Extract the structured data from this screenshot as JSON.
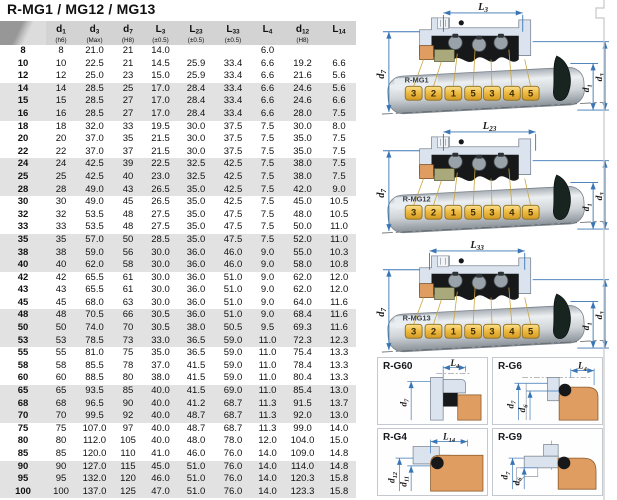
{
  "page_title": "R-MG1 / MG12 / MG13",
  "table": {
    "header": [
      {
        "base": "",
        "sub": "",
        "note": ""
      },
      {
        "base": "d",
        "sub": "1",
        "note": "(h6)"
      },
      {
        "base": "d",
        "sub": "3",
        "note": "(Max)"
      },
      {
        "base": "d",
        "sub": "7",
        "note": "(H8)"
      },
      {
        "base": "L",
        "sub": "3",
        "note": "(±0.5)"
      },
      {
        "base": "L",
        "sub": "23",
        "note": "(±0.5)"
      },
      {
        "base": "L",
        "sub": "33",
        "note": "(±0.5)"
      },
      {
        "base": "L",
        "sub": "4",
        "note": ""
      },
      {
        "base": "d",
        "sub": "12",
        "note": "(H8)"
      },
      {
        "base": "L",
        "sub": "14",
        "note": ""
      }
    ],
    "rows": [
      [
        "8",
        "8",
        "21.0",
        "21",
        "14.0",
        "",
        "",
        "6.0",
        "",
        ""
      ],
      [
        "10",
        "10",
        "22.5",
        "21",
        "14.5",
        "25.9",
        "33.4",
        "6.6",
        "19.2",
        "6.6"
      ],
      [
        "12",
        "12",
        "25.0",
        "23",
        "15.0",
        "25.9",
        "33.4",
        "6.6",
        "21.6",
        "5.6"
      ],
      [
        "14",
        "14",
        "28.5",
        "25",
        "17.0",
        "28.4",
        "33.4",
        "6.6",
        "24.6",
        "5.6"
      ],
      [
        "15",
        "15",
        "28.5",
        "27",
        "17.0",
        "28.4",
        "33.4",
        "6.6",
        "24.6",
        "6.6"
      ],
      [
        "16",
        "16",
        "28.5",
        "27",
        "17.0",
        "28.4",
        "33.4",
        "6.6",
        "28.0",
        "7.5"
      ],
      [
        "18",
        "18",
        "32.0",
        "33",
        "19.5",
        "30.0",
        "37.5",
        "7.5",
        "30.0",
        "8.0"
      ],
      [
        "20",
        "20",
        "37.0",
        "35",
        "21.5",
        "30.0",
        "37.5",
        "7.5",
        "35.0",
        "7.5"
      ],
      [
        "22",
        "22",
        "37.0",
        "37",
        "21.5",
        "30.0",
        "37.5",
        "7.5",
        "35.0",
        "7.5"
      ],
      [
        "24",
        "24",
        "42.5",
        "39",
        "22.5",
        "32.5",
        "42.5",
        "7.5",
        "38.0",
        "7.5"
      ],
      [
        "25",
        "25",
        "42.5",
        "40",
        "23.0",
        "32.5",
        "42.5",
        "7.5",
        "38.0",
        "7.5"
      ],
      [
        "28",
        "28",
        "49.0",
        "43",
        "26.5",
        "35.0",
        "42.5",
        "7.5",
        "42.0",
        "9.0"
      ],
      [
        "30",
        "30",
        "49.0",
        "45",
        "26.5",
        "35.0",
        "42.5",
        "7.5",
        "45.0",
        "10.5"
      ],
      [
        "32",
        "32",
        "53.5",
        "48",
        "27.5",
        "35.0",
        "47.5",
        "7.5",
        "48.0",
        "10.5"
      ],
      [
        "33",
        "33",
        "53.5",
        "48",
        "27.5",
        "35.0",
        "47.5",
        "7.5",
        "50.0",
        "11.0"
      ],
      [
        "35",
        "35",
        "57.0",
        "50",
        "28.5",
        "35.0",
        "47.5",
        "7.5",
        "52.0",
        "11.0"
      ],
      [
        "38",
        "38",
        "59.0",
        "56",
        "30.0",
        "36.0",
        "46.0",
        "9.0",
        "55.0",
        "10.3"
      ],
      [
        "40",
        "40",
        "62.0",
        "58",
        "30.0",
        "36.0",
        "46.0",
        "9.0",
        "58.0",
        "10.8"
      ],
      [
        "42",
        "42",
        "65.5",
        "61",
        "30.0",
        "36.0",
        "51.0",
        "9.0",
        "62.0",
        "12.0"
      ],
      [
        "43",
        "43",
        "65.5",
        "61",
        "30.0",
        "36.0",
        "51.0",
        "9.0",
        "62.0",
        "12.0"
      ],
      [
        "45",
        "45",
        "68.0",
        "63",
        "30.0",
        "36.0",
        "51.0",
        "9.0",
        "64.0",
        "11.6"
      ],
      [
        "48",
        "48",
        "70.5",
        "66",
        "30.5",
        "36.0",
        "51.0",
        "9.0",
        "68.4",
        "11.6"
      ],
      [
        "50",
        "50",
        "74.0",
        "70",
        "30.5",
        "38.0",
        "50.5",
        "9.5",
        "69.3",
        "11.6"
      ],
      [
        "53",
        "53",
        "78.5",
        "73",
        "33.0",
        "36.5",
        "59.0",
        "11.0",
        "72.3",
        "12.3"
      ],
      [
        "55",
        "55",
        "81.0",
        "75",
        "35.0",
        "36.5",
        "59.0",
        "11.0",
        "75.4",
        "13.3"
      ],
      [
        "58",
        "58",
        "85.5",
        "78",
        "37.0",
        "41.5",
        "59.0",
        "11.0",
        "78.4",
        "13.3"
      ],
      [
        "60",
        "60",
        "88.5",
        "80",
        "38.0",
        "41.5",
        "59.0",
        "11.0",
        "80.4",
        "13.3"
      ],
      [
        "65",
        "65",
        "93.5",
        "85",
        "40.0",
        "41.5",
        "69.0",
        "11.0",
        "85.4",
        "13.0"
      ],
      [
        "68",
        "68",
        "96.5",
        "90",
        "40.0",
        "41.2",
        "68.7",
        "11.3",
        "91.5",
        "13.7"
      ],
      [
        "70",
        "70",
        "99.5",
        "92",
        "40.0",
        "48.7",
        "68.7",
        "11.3",
        "92.0",
        "13.0"
      ],
      [
        "75",
        "75",
        "107.0",
        "97",
        "40.0",
        "48.7",
        "68.7",
        "11.3",
        "99.0",
        "14.0"
      ],
      [
        "80",
        "80",
        "112.0",
        "105",
        "40.0",
        "48.0",
        "78.0",
        "12.0",
        "104.0",
        "15.0"
      ],
      [
        "85",
        "85",
        "120.0",
        "110",
        "41.0",
        "46.0",
        "76.0",
        "14.0",
        "109.0",
        "14.8"
      ],
      [
        "90",
        "90",
        "127.0",
        "115",
        "45.0",
        "51.0",
        "76.0",
        "14.0",
        "114.0",
        "14.8"
      ],
      [
        "95",
        "95",
        "132.0",
        "120",
        "46.0",
        "51.0",
        "76.0",
        "14.0",
        "120.3",
        "15.8"
      ],
      [
        "100",
        "100",
        "137.0",
        "125",
        "47.0",
        "51.0",
        "76.0",
        "14.0",
        "123.3",
        "15.8"
      ]
    ]
  },
  "seal_diagrams": [
    {
      "label": "R-MG1",
      "top_dim": {
        "base": "L",
        "sub": "3"
      },
      "left_dim": {
        "base": "d",
        "sub": "7"
      },
      "right_dim_inner": {
        "base": "d",
        "sub": "1"
      },
      "right_dim_outer": {
        "base": "d",
        "sub": "3"
      },
      "badges": [
        "3",
        "2",
        "1",
        "5",
        "3",
        "4",
        "5"
      ]
    },
    {
      "label": "R-MG12",
      "top_dim": {
        "base": "L",
        "sub": "23"
      },
      "left_dim": {
        "base": "d",
        "sub": "7"
      },
      "right_dim_inner": {
        "base": "d",
        "sub": "1"
      },
      "right_dim_outer": {
        "base": "d",
        "sub": "3"
      },
      "badges": [
        "3",
        "2",
        "1",
        "5",
        "3",
        "4",
        "5"
      ]
    },
    {
      "label": "R-MG13",
      "top_dim": {
        "base": "L",
        "sub": "33"
      },
      "left_dim": {
        "base": "d",
        "sub": "7"
      },
      "right_dim_inner": {
        "base": "d",
        "sub": "1"
      },
      "right_dim_outer": {
        "base": "d",
        "sub": "3"
      },
      "badges": [
        "3",
        "2",
        "1",
        "5",
        "3",
        "4",
        "5"
      ]
    }
  ],
  "seat_diagrams": [
    {
      "label": "R-G60",
      "top_dim": {
        "base": "L",
        "sub": "4"
      },
      "left_dims": [
        {
          "base": "d",
          "sub": "7"
        }
      ]
    },
    {
      "label": "R-G6",
      "top_dim": {
        "base": "L",
        "sub": "4"
      },
      "left_dims": [
        {
          "base": "d",
          "sub": "7"
        },
        {
          "base": "d",
          "sub": "6"
        }
      ]
    },
    {
      "label": "R-G4",
      "top_dim": {
        "base": "L",
        "sub": "14"
      },
      "left_dims": [
        {
          "base": "d",
          "sub": "12"
        },
        {
          "base": "d",
          "sub": "11"
        }
      ]
    },
    {
      "label": "R-G9",
      "top_dim": null,
      "left_dims": [
        {
          "base": "d",
          "sub": "7"
        },
        {
          "base": "d",
          "sub": "6"
        }
      ]
    }
  ],
  "colors": {
    "accent_dim": "#3a76b5",
    "housing_fill": "#dbe3ee",
    "housing_stroke": "#7d8894",
    "seat_orange": "#df9d61",
    "seat_orange_stroke": "#8a5a28",
    "rubber_black": "#17181a",
    "spring_gray": "#99a1a9",
    "olive_part": "#a9a97b",
    "badge_gold": "#edb93f",
    "badge_border": "#8d6d1c",
    "row_shade": "#e2e2e2",
    "header_bg": "#d3d3d3"
  }
}
